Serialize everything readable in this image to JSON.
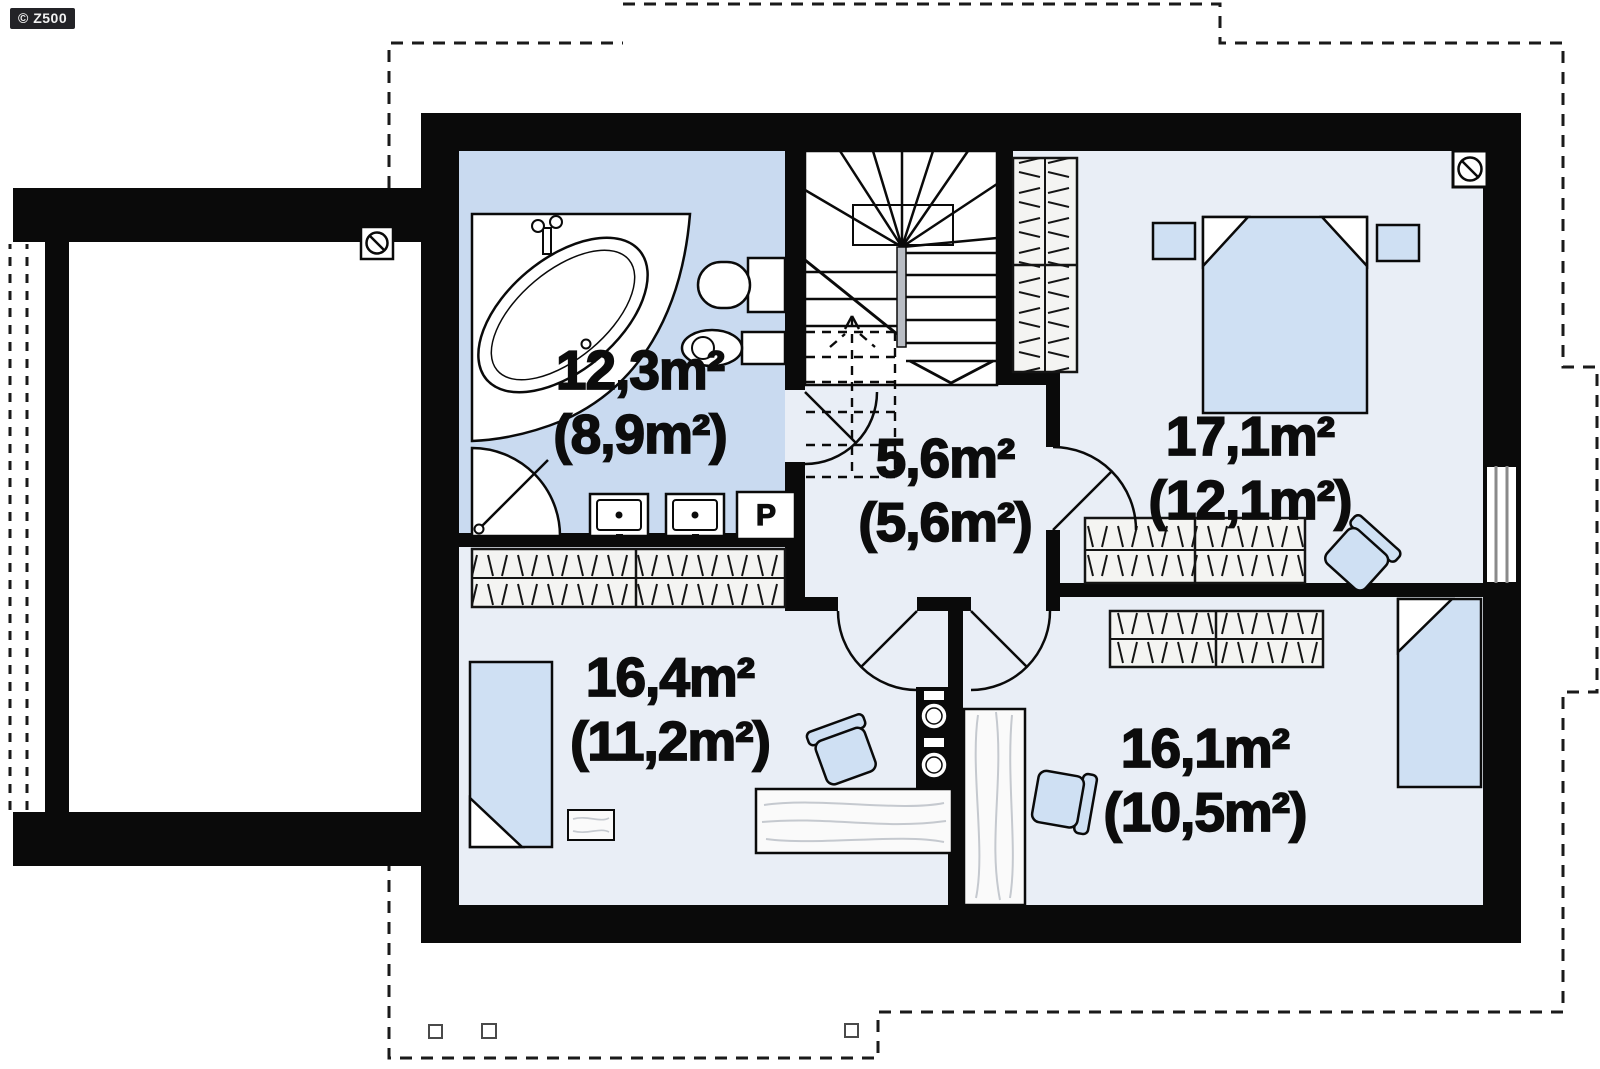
{
  "badge": {
    "label": "© Z500"
  },
  "rooms": [
    {
      "id": "bathroom",
      "area": "12,3m²",
      "area_after_slopes": "(8,9m²)"
    },
    {
      "id": "hallway-stairs",
      "area": "5,6m²",
      "area_after_slopes": "(5,6m²)"
    },
    {
      "id": "bedroom-top-right",
      "area": "17,1m²",
      "area_after_slopes": "(12,1m²)"
    },
    {
      "id": "bedroom-bottom-left",
      "area": "16,4m²",
      "area_after_slopes": "(11,2m²)"
    },
    {
      "id": "bedroom-bottom-right",
      "area": "16,1m²",
      "area_after_slopes": "(10,5m²)"
    }
  ],
  "appliances": {
    "washing_machine_label": "P"
  },
  "colors": {
    "wall": "#0a0a0a",
    "bathroom_floor": "#c9daf0",
    "room_floor": "#e9eef6",
    "furniture_blue": "#cfe0f3",
    "badge_background": "#232327"
  },
  "icons": [
    "bathtub-icon",
    "shower-icon",
    "toilet-icon",
    "bidet-icon",
    "washbasin-icon",
    "washing-machine-icon",
    "staircase-icon",
    "wardrobe-icon",
    "double-bed-icon",
    "single-bed-icon",
    "nightstand-icon",
    "desk-icon",
    "chair-icon",
    "rug-icon",
    "plant-shelf-icon",
    "chimney-icon",
    "window-icon",
    "door-arc-icon",
    "roof-outline"
  ]
}
